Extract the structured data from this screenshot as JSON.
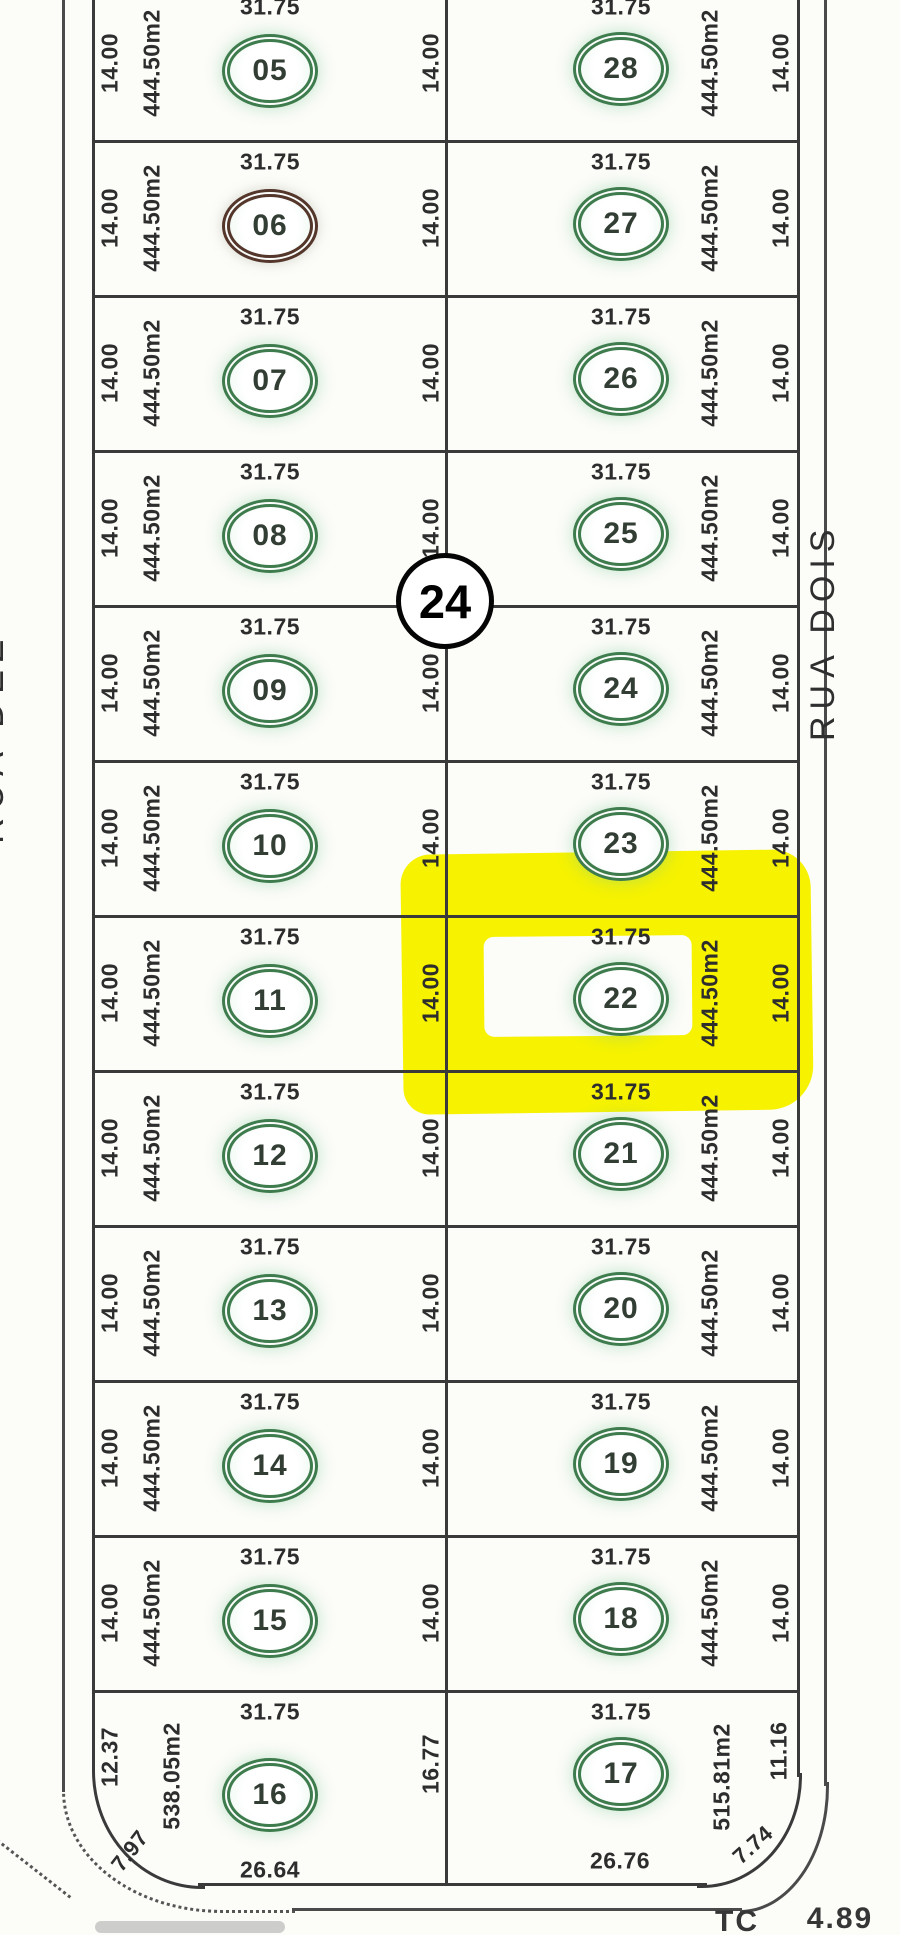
{
  "streets": {
    "left_upper": "Rua Antonio Benedit",
    "left_lower": "RUA DEZ",
    "right": "RUA DOIS"
  },
  "block": {
    "number": "24"
  },
  "highlight": {
    "lot": "22",
    "color": "#f6f200"
  },
  "colors": {
    "ring_green": "#3e7c4e",
    "ring_lot06": "#54362b",
    "line": "#3a3a3a",
    "highlight_yellow": "#f6f200"
  },
  "bottom_annotations": {
    "tc": "TC",
    "value": "4.89"
  },
  "rows": [
    {
      "left": {
        "num": "05",
        "w": "14.00",
        "area": "444.50m2",
        "top": "31.75"
      },
      "mid": "14.00",
      "right": {
        "num": "28",
        "top": "31.75",
        "area": "444.50m2",
        "w": "14.00"
      }
    },
    {
      "left": {
        "num": "06",
        "w": "14.00",
        "area": "444.50m2",
        "top": "31.75"
      },
      "mid": "14.00",
      "right": {
        "num": "27",
        "top": "31.75",
        "area": "444.50m2",
        "w": "14.00"
      }
    },
    {
      "left": {
        "num": "07",
        "w": "14.00",
        "area": "444.50m2",
        "top": "31.75"
      },
      "mid": "14.00",
      "right": {
        "num": "26",
        "top": "31.75",
        "area": "444.50m2",
        "w": "14.00"
      }
    },
    {
      "left": {
        "num": "08",
        "w": "14.00",
        "area": "444.50m2",
        "top": "31.75"
      },
      "mid": "14.00",
      "right": {
        "num": "25",
        "top": "31.75",
        "area": "444.50m2",
        "w": "14.00"
      }
    },
    {
      "left": {
        "num": "09",
        "w": "14.00",
        "area": "444.50m2",
        "top": "31.75"
      },
      "mid": "14.00",
      "right": {
        "num": "24",
        "top": "31.75",
        "area": "444.50m2",
        "w": "14.00"
      }
    },
    {
      "left": {
        "num": "10",
        "w": "14.00",
        "area": "444.50m2",
        "top": "31.75"
      },
      "mid": "14.00",
      "right": {
        "num": "23",
        "top": "31.75",
        "area": "444.50m2",
        "w": "14.00"
      }
    },
    {
      "left": {
        "num": "11",
        "w": "14.00",
        "area": "444.50m2",
        "top": "31.75"
      },
      "mid": "14.00",
      "right": {
        "num": "22",
        "top": "31.75",
        "area": "444.50m2",
        "w": "14.00"
      }
    },
    {
      "left": {
        "num": "12",
        "w": "14.00",
        "area": "444.50m2",
        "top": "31.75"
      },
      "mid": "14.00",
      "right": {
        "num": "21",
        "top": "31.75",
        "area": "444.50m2",
        "w": "14.00"
      }
    },
    {
      "left": {
        "num": "13",
        "w": "14.00",
        "area": "444.50m2",
        "top": "31.75"
      },
      "mid": "14.00",
      "right": {
        "num": "20",
        "top": "31.75",
        "area": "444.50m2",
        "w": "14.00"
      }
    },
    {
      "left": {
        "num": "14",
        "w": "14.00",
        "area": "444.50m2",
        "top": "31.75"
      },
      "mid": "14.00",
      "right": {
        "num": "19",
        "top": "31.75",
        "area": "444.50m2",
        "w": "14.00"
      }
    },
    {
      "left": {
        "num": "15",
        "w": "14.00",
        "area": "444.50m2",
        "top": "31.75"
      },
      "mid": "14.00",
      "right": {
        "num": "18",
        "top": "31.75",
        "area": "444.50m2",
        "w": "14.00"
      }
    },
    {
      "left": {
        "num": "16",
        "w": "12.37",
        "area": "538.05m2",
        "top": "31.75",
        "bottom": "26.64",
        "corner": "7.97"
      },
      "mid": "16.77",
      "right": {
        "num": "17",
        "top": "31.75",
        "area": "515.81m2",
        "w": "11.16",
        "bottom": "26.76",
        "corner": "7.74"
      }
    }
  ]
}
